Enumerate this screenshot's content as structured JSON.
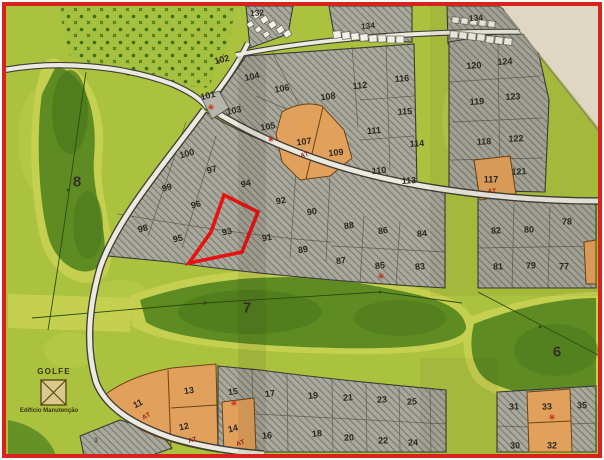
{
  "map": {
    "type": "golf-resort-lot-plan",
    "highlighted_lot": "93",
    "legend": {
      "title": "GOLFE",
      "subtitle": "Edifício Manutenção"
    },
    "colors": {
      "frame": "#d7231d",
      "ground": "#abc23f",
      "fairway": "#5e8c23",
      "fairway_fringe": "#c6d050",
      "hatch_block": "#a6a69b",
      "orange_lot": "#e1a15c",
      "road": "#ece9e0",
      "paper_corner": "#e9e1cf",
      "highlight": "#ea1111"
    },
    "labels": [
      {
        "t": "132",
        "x": 257,
        "y": 13,
        "c": "strip",
        "r": -4
      },
      {
        "t": "134",
        "x": 368,
        "y": 26,
        "c": "strip",
        "r": -6
      },
      {
        "t": "134",
        "x": 476,
        "y": 18,
        "c": "strip",
        "r": -4
      },
      {
        "t": "102",
        "x": 222,
        "y": 60,
        "c": "lot",
        "r": -14
      },
      {
        "t": "104",
        "x": 252,
        "y": 77,
        "c": "lot",
        "r": -12
      },
      {
        "t": "106",
        "x": 282,
        "y": 89,
        "c": "lot",
        "r": -10
      },
      {
        "t": "108",
        "x": 328,
        "y": 97,
        "c": "lot",
        "r": -8
      },
      {
        "t": "112",
        "x": 360,
        "y": 86,
        "c": "lot",
        "r": -6
      },
      {
        "t": "116",
        "x": 402,
        "y": 79,
        "c": "lot",
        "r": -4
      },
      {
        "t": "101",
        "x": 208,
        "y": 96,
        "c": "lot",
        "r": -14
      },
      {
        "t": "103",
        "x": 234,
        "y": 111,
        "c": "lot",
        "r": -12
      },
      {
        "t": "105",
        "x": 268,
        "y": 127,
        "c": "lot",
        "r": -10
      },
      {
        "t": "107",
        "x": 304,
        "y": 142,
        "c": "lot",
        "r": -8
      },
      {
        "t": "109",
        "x": 336,
        "y": 153,
        "c": "lot",
        "r": -6
      },
      {
        "t": "111",
        "x": 374,
        "y": 131,
        "c": "lot",
        "r": -5
      },
      {
        "t": "115",
        "x": 405,
        "y": 112,
        "c": "lot",
        "r": -4
      },
      {
        "t": "114",
        "x": 417,
        "y": 144,
        "c": "lot",
        "r": -4
      },
      {
        "t": "110",
        "x": 379,
        "y": 171,
        "c": "lot",
        "r": -5
      },
      {
        "t": "113",
        "x": 409,
        "y": 181,
        "c": "lot",
        "r": -4
      },
      {
        "t": "120",
        "x": 474,
        "y": 66,
        "c": "lot",
        "r": -4
      },
      {
        "t": "124",
        "x": 505,
        "y": 62,
        "c": "lot",
        "r": -4
      },
      {
        "t": "119",
        "x": 477,
        "y": 102,
        "c": "lot",
        "r": -4
      },
      {
        "t": "123",
        "x": 513,
        "y": 97,
        "c": "lot",
        "r": -3
      },
      {
        "t": "118",
        "x": 484,
        "y": 142,
        "c": "lot",
        "r": -3
      },
      {
        "t": "122",
        "x": 516,
        "y": 139,
        "c": "lot",
        "r": -3
      },
      {
        "t": "117",
        "x": 491,
        "y": 180,
        "c": "lot",
        "r": 0
      },
      {
        "t": "121",
        "x": 519,
        "y": 172,
        "c": "lot",
        "r": -3
      },
      {
        "t": "100",
        "x": 187,
        "y": 154,
        "c": "lot",
        "r": -16
      },
      {
        "t": "97",
        "x": 212,
        "y": 170,
        "c": "lot",
        "r": -15
      },
      {
        "t": "94",
        "x": 246,
        "y": 184,
        "c": "lot",
        "r": -13
      },
      {
        "t": "99",
        "x": 167,
        "y": 188,
        "c": "lot",
        "r": -16
      },
      {
        "t": "96",
        "x": 196,
        "y": 205,
        "c": "lot",
        "r": -14
      },
      {
        "t": "92",
        "x": 281,
        "y": 201,
        "c": "lot",
        "r": -11
      },
      {
        "t": "90",
        "x": 312,
        "y": 212,
        "c": "lot",
        "r": -10
      },
      {
        "t": "98",
        "x": 143,
        "y": 229,
        "c": "lot",
        "r": -15
      },
      {
        "t": "95",
        "x": 178,
        "y": 239,
        "c": "lot",
        "r": -13
      },
      {
        "t": "93",
        "x": 227,
        "y": 232,
        "c": "lot",
        "r": -12
      },
      {
        "t": "91",
        "x": 267,
        "y": 238,
        "c": "lot",
        "r": -10
      },
      {
        "t": "89",
        "x": 303,
        "y": 250,
        "c": "lot",
        "r": -9
      },
      {
        "t": "88",
        "x": 349,
        "y": 226,
        "c": "lot",
        "r": -8
      },
      {
        "t": "86",
        "x": 383,
        "y": 231,
        "c": "lot",
        "r": -7
      },
      {
        "t": "84",
        "x": 422,
        "y": 234,
        "c": "lot",
        "r": -5
      },
      {
        "t": "87",
        "x": 341,
        "y": 261,
        "c": "lot",
        "r": -7
      },
      {
        "t": "85",
        "x": 380,
        "y": 266,
        "c": "lot",
        "r": -6
      },
      {
        "t": "83",
        "x": 420,
        "y": 267,
        "c": "lot",
        "r": -5
      },
      {
        "t": "82",
        "x": 496,
        "y": 231,
        "c": "lot",
        "r": -3
      },
      {
        "t": "80",
        "x": 529,
        "y": 230,
        "c": "lot",
        "r": -2
      },
      {
        "t": "78",
        "x": 567,
        "y": 222,
        "c": "lot",
        "r": -1
      },
      {
        "t": "81",
        "x": 498,
        "y": 267,
        "c": "lot",
        "r": -2
      },
      {
        "t": "79",
        "x": 531,
        "y": 266,
        "c": "lot",
        "r": -1
      },
      {
        "t": "77",
        "x": 564,
        "y": 267,
        "c": "lot",
        "r": 0
      },
      {
        "t": "11",
        "x": 138,
        "y": 404,
        "c": "lot",
        "r": -28
      },
      {
        "t": "13",
        "x": 189,
        "y": 391,
        "c": "lot",
        "r": -8
      },
      {
        "t": "12",
        "x": 184,
        "y": 427,
        "c": "lot",
        "r": -12
      },
      {
        "t": "14",
        "x": 233,
        "y": 429,
        "c": "lot",
        "r": -14
      },
      {
        "t": "15",
        "x": 233,
        "y": 392,
        "c": "lot",
        "r": -7
      },
      {
        "t": "17",
        "x": 270,
        "y": 394,
        "c": "lot",
        "r": -6
      },
      {
        "t": "19",
        "x": 313,
        "y": 396,
        "c": "lot",
        "r": -5
      },
      {
        "t": "21",
        "x": 348,
        "y": 398,
        "c": "lot",
        "r": -4
      },
      {
        "t": "23",
        "x": 382,
        "y": 400,
        "c": "lot",
        "r": -3
      },
      {
        "t": "25",
        "x": 412,
        "y": 402,
        "c": "lot",
        "r": -3
      },
      {
        "t": "16",
        "x": 267,
        "y": 436,
        "c": "lot",
        "r": -5
      },
      {
        "t": "18",
        "x": 317,
        "y": 434,
        "c": "lot",
        "r": -4
      },
      {
        "t": "20",
        "x": 349,
        "y": 438,
        "c": "lot",
        "r": -3
      },
      {
        "t": "22",
        "x": 383,
        "y": 441,
        "c": "lot",
        "r": -2
      },
      {
        "t": "24",
        "x": 413,
        "y": 443,
        "c": "lot",
        "r": -2
      },
      {
        "t": "31",
        "x": 514,
        "y": 407,
        "c": "lot",
        "r": -3
      },
      {
        "t": "33",
        "x": 547,
        "y": 407,
        "c": "lot",
        "r": -3
      },
      {
        "t": "35",
        "x": 582,
        "y": 406,
        "c": "lot",
        "r": 0
      },
      {
        "t": "30",
        "x": 515,
        "y": 446,
        "c": "lot",
        "r": -2
      },
      {
        "t": "32",
        "x": 552,
        "y": 446,
        "c": "lot",
        "r": 0
      },
      {
        "t": "3",
        "x": 96,
        "y": 441,
        "c": "small",
        "r": 0
      },
      {
        "t": "8",
        "x": 77,
        "y": 182,
        "c": "hole",
        "r": 0
      },
      {
        "t": "7",
        "x": 247,
        "y": 308,
        "c": "hole",
        "r": 0
      },
      {
        "t": "6",
        "x": 557,
        "y": 352,
        "c": "hole",
        "r": 0
      },
      {
        "t": "AT",
        "x": 147,
        "y": 417,
        "c": "at",
        "r": -30
      },
      {
        "t": "AT",
        "x": 193,
        "y": 441,
        "c": "at",
        "r": -15
      },
      {
        "t": "AT",
        "x": 241,
        "y": 444,
        "c": "at",
        "r": -20
      },
      {
        "t": "AT",
        "x": 305,
        "y": 156,
        "c": "at",
        "r": -15
      },
      {
        "t": "AT",
        "x": 492,
        "y": 192,
        "c": "at",
        "r": 0
      },
      {
        "t": "✳",
        "x": 211,
        "y": 108,
        "c": "mark",
        "r": 0
      },
      {
        "t": "✳",
        "x": 271,
        "y": 140,
        "c": "mark",
        "r": 0
      },
      {
        "t": "✳",
        "x": 381,
        "y": 277,
        "c": "mark",
        "r": 0
      },
      {
        "t": "✳",
        "x": 234,
        "y": 404,
        "c": "mark",
        "r": 0
      },
      {
        "t": "✳",
        "x": 552,
        "y": 418,
        "c": "mark",
        "r": 0
      }
    ]
  }
}
